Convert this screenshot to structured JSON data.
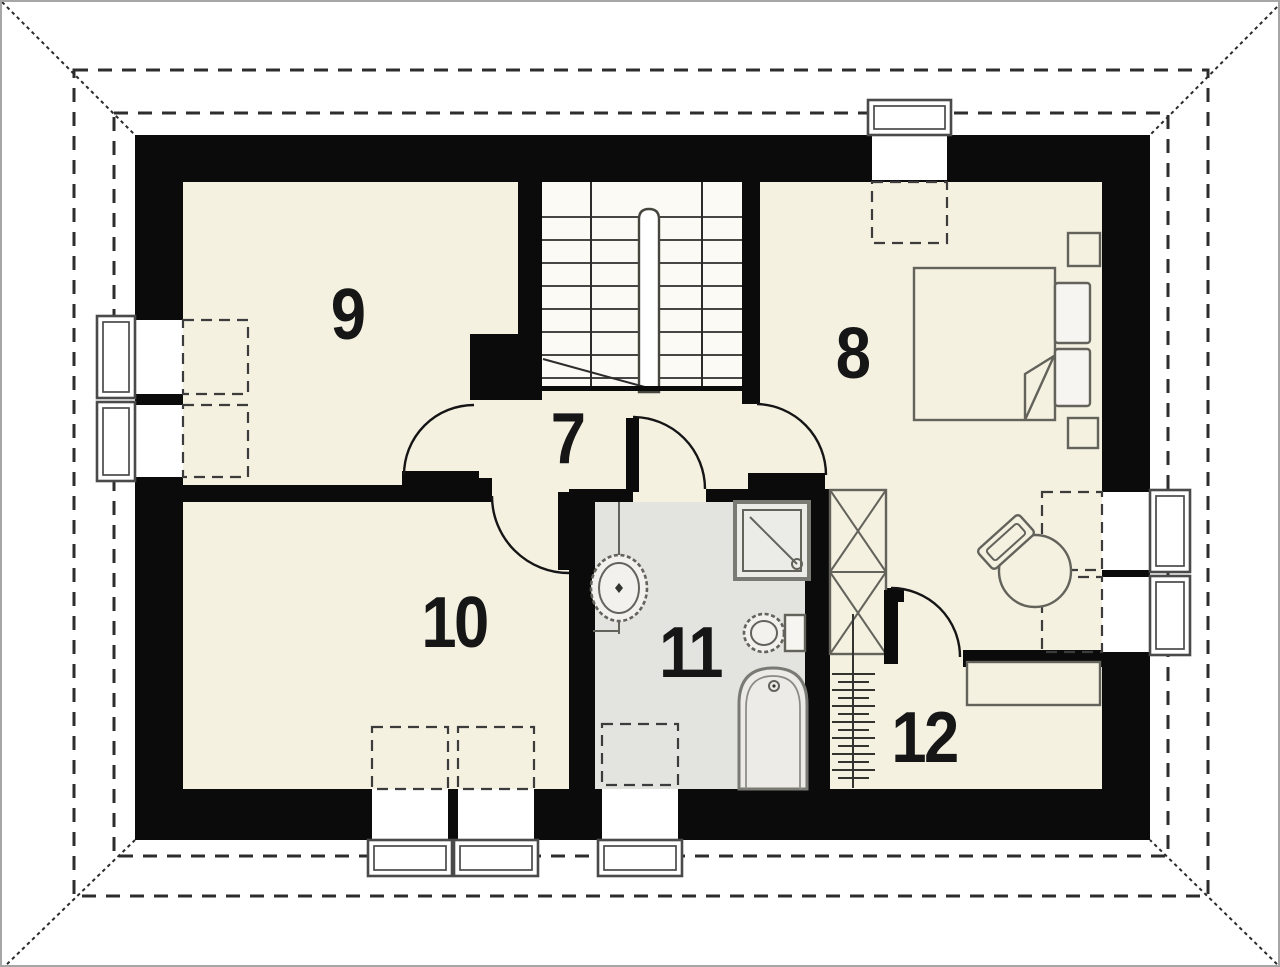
{
  "plan_type": "floor-plan-attic-storey",
  "rooms": [
    {
      "label": "7"
    },
    {
      "label": "8"
    },
    {
      "label": "9"
    },
    {
      "label": "10"
    },
    {
      "label": "11"
    },
    {
      "label": "12"
    }
  ],
  "fixtures": [
    "staircase-double-flight",
    "bed-with-pillows",
    "nightstand",
    "blanket-fold",
    "desk-chair",
    "wardrobe-x-symbol",
    "towel-radiator",
    "washbasin",
    "toilet",
    "bathtub",
    "shower-cabin",
    "desk-counter",
    "roof-window-projection-dashed",
    "window-frame",
    "roof-eave-dashed-outline",
    "roof-hip-line"
  ],
  "colors": {
    "wall": "#0b0b0b",
    "floor": "#f4f1e1",
    "bathroom_floor": "#e3e3df",
    "stairs_floor": "#fbfaf4",
    "furniture_line": "#63635c",
    "frame_line": "#4a4a4a",
    "dash_line": "#2d2d2d",
    "label": "#161616"
  }
}
